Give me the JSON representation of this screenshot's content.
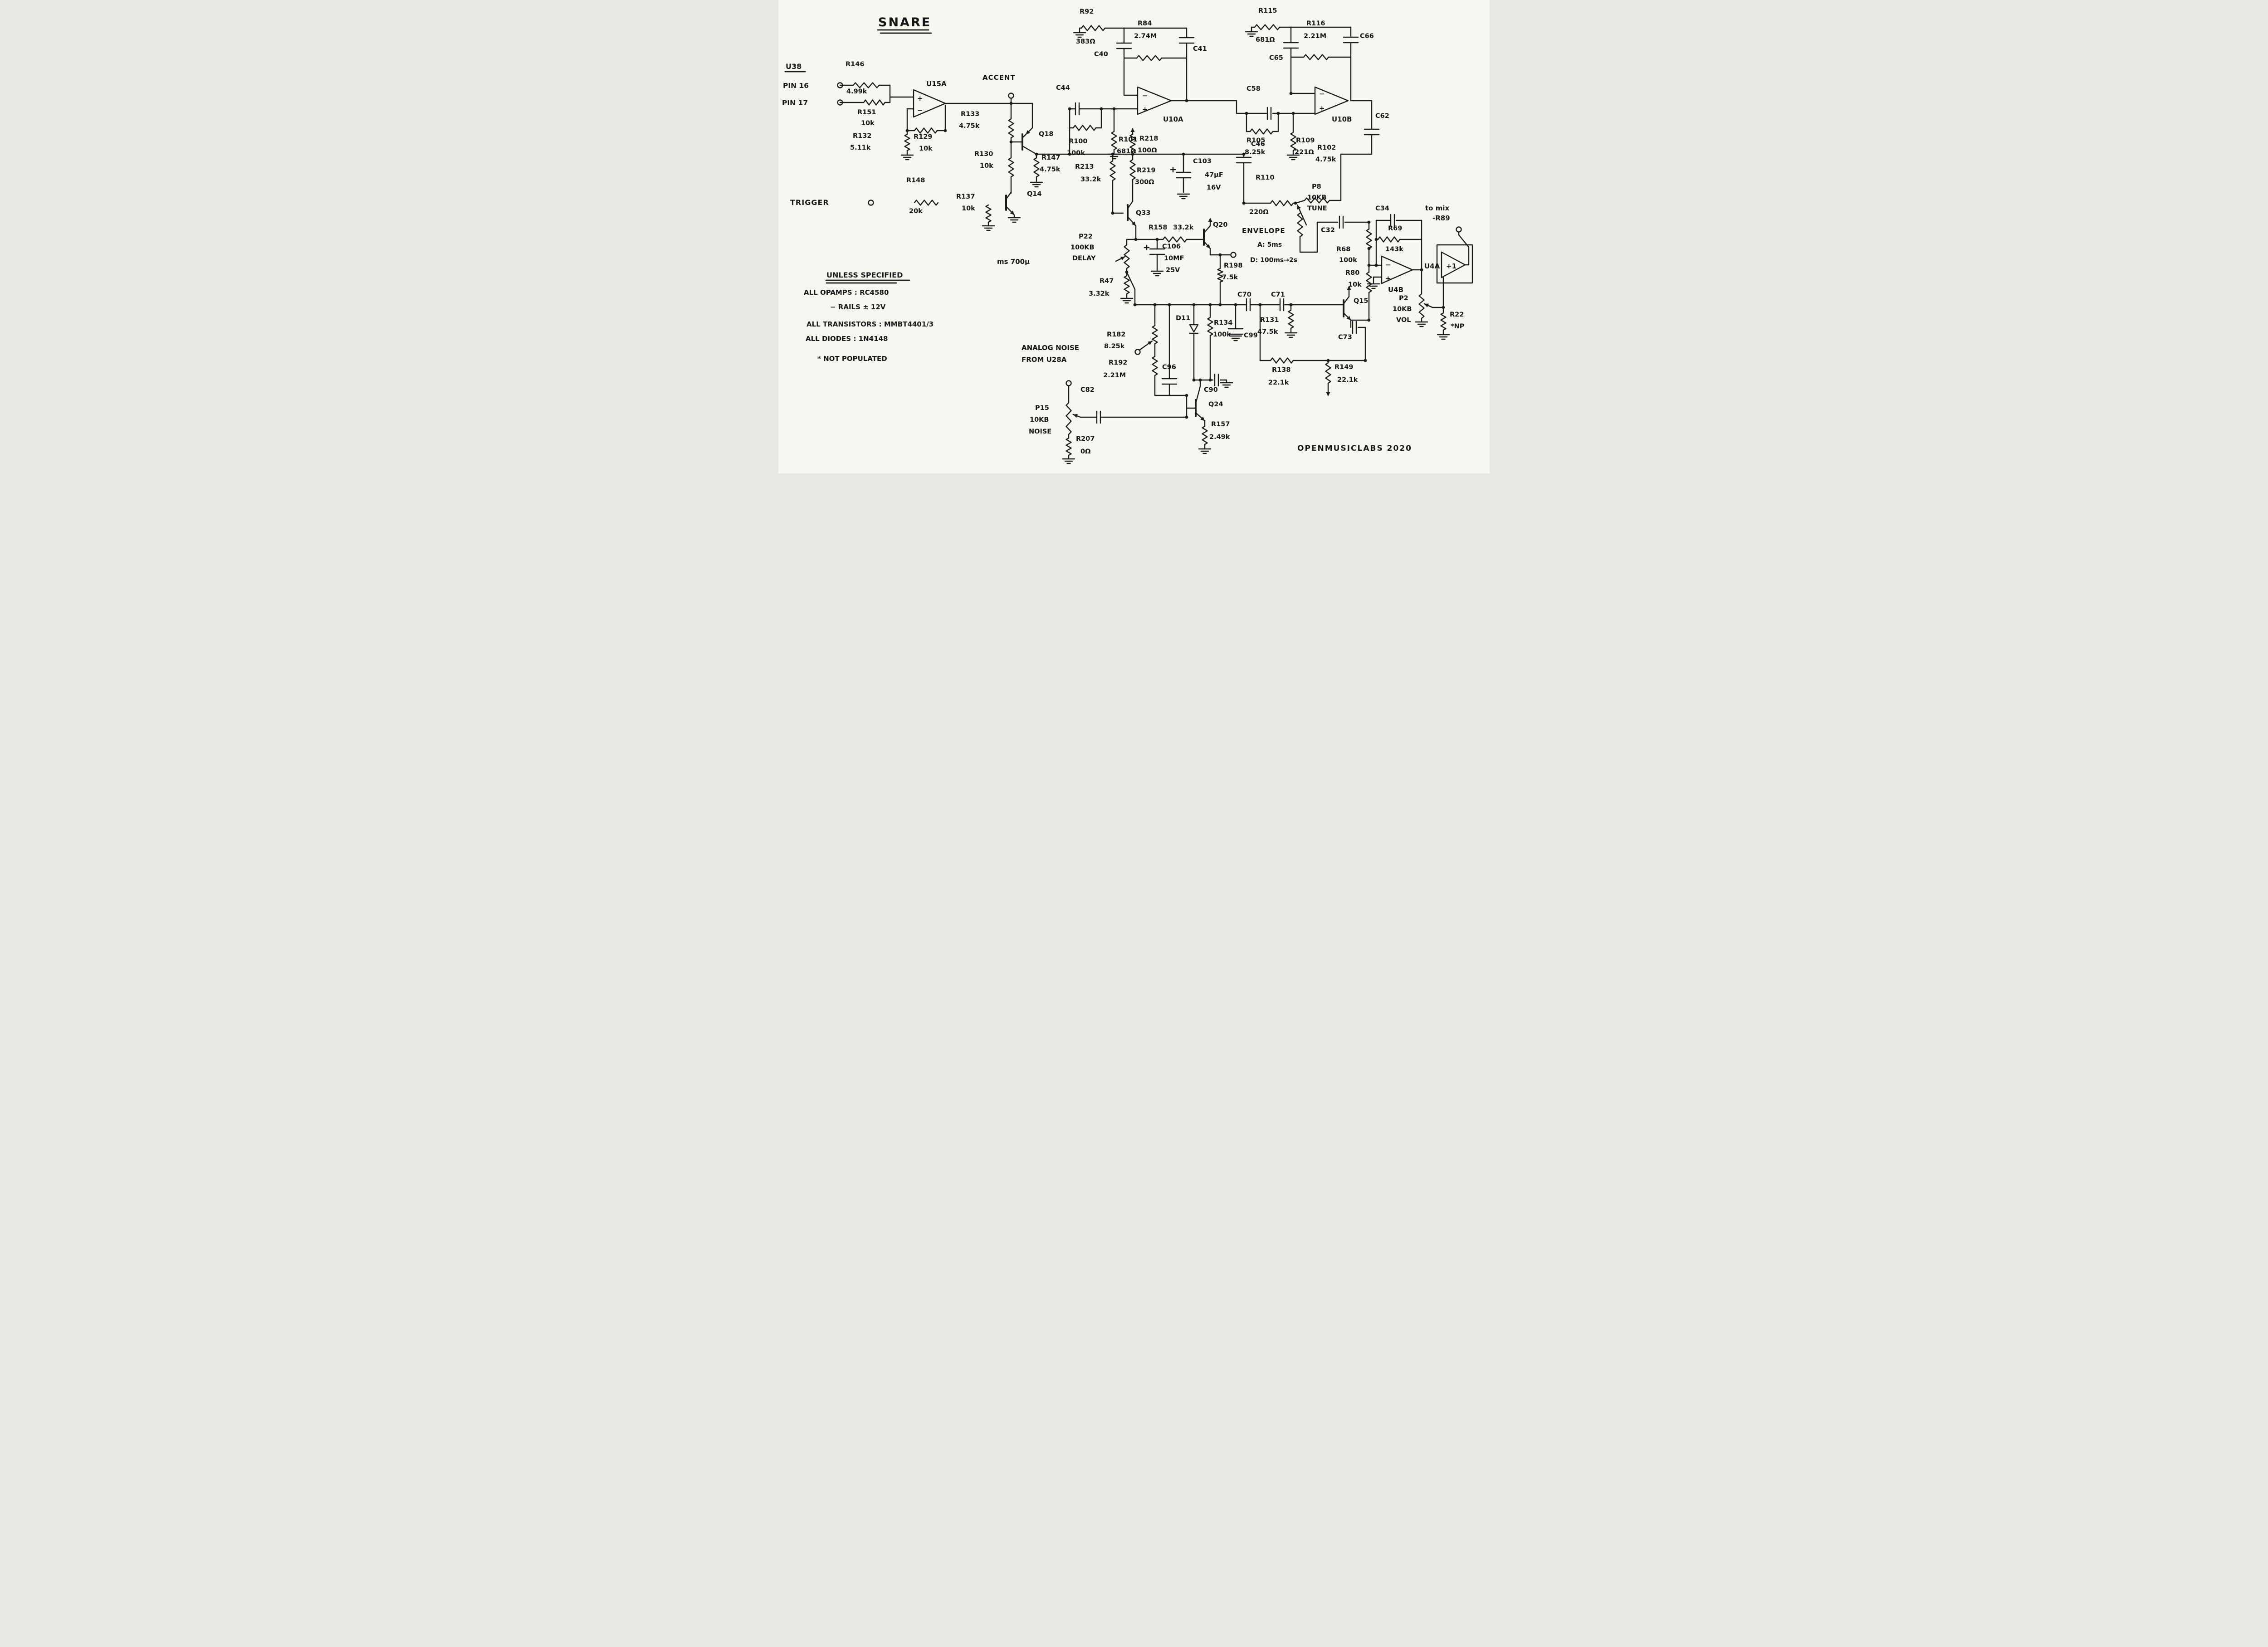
{
  "title": "SNARE",
  "footer": "OPENMUSICLABS   2020",
  "trigger_label": "TRIGGER",
  "accent_label": "ACCENT",
  "misc_label": "ms   700µ",
  "u38": {
    "label": "U38",
    "pin16": "PIN 16",
    "pin17": "PIN 17"
  },
  "noise": {
    "line1": "ANALOG NOISE",
    "line2": "FROM U28A"
  },
  "output": {
    "line1": "to mix",
    "line2": "-R89"
  },
  "buffer": {
    "gain": "+1"
  },
  "envelope": {
    "title": "ENVELOPE",
    "attack": "A: 5ms",
    "decay": "D: 100ms→2s"
  },
  "notes": {
    "heading": "UNLESS SPECIFIED",
    "l1": "ALL OPAMPS : RC4580",
    "l2": "− RAILS ± 12V",
    "l3": "ALL TRANSISTORS : MMBT4401/3",
    "l4": "ALL DIODES : 1N4148",
    "l5": "* NOT POPULATED"
  },
  "opamps": {
    "U15A": {
      "label": "U15A",
      "top": "+",
      "bottom": "−"
    },
    "U10A": {
      "label": "U10A",
      "top": "−",
      "bottom": "+"
    },
    "U10B": {
      "label": "U10B",
      "top": "−",
      "bottom": "+"
    },
    "U4B": {
      "label": "U4B",
      "top": "−",
      "bottom": "+"
    },
    "U4A": {
      "label": "U4A"
    }
  },
  "components": {
    "R146": {
      "label": "R146",
      "value": "4.99k"
    },
    "R151": {
      "label": "R151",
      "value": "10k"
    },
    "R132": {
      "label": "R132",
      "value": "5.11k"
    },
    "R129": {
      "label": "R129",
      "value": "10k"
    },
    "R133": {
      "label": "R133",
      "value": "4.75k"
    },
    "R130": {
      "label": "R130",
      "value": "10k"
    },
    "R147": {
      "label": "R147",
      "value": "4.75k"
    },
    "R148": {
      "label": "R148",
      "value": "20k"
    },
    "R137": {
      "label": "R137",
      "value": "10k"
    },
    "Q14": {
      "label": "Q14"
    },
    "Q18": {
      "label": "Q18"
    },
    "R92": {
      "label": "R92",
      "value": "383Ω"
    },
    "C40": {
      "label": "C40"
    },
    "R84": {
      "label": "R84",
      "value": "2.74M"
    },
    "C41": {
      "label": "C41"
    },
    "C44": {
      "label": "C44"
    },
    "R100": {
      "label": "R100",
      "value": "100k"
    },
    "R101": {
      "label": "R101",
      "value": "681Ω"
    },
    "R115": {
      "label": "R115",
      "value": "681Ω"
    },
    "C65": {
      "label": "C65"
    },
    "R116": {
      "label": "R116",
      "value": "2.21M"
    },
    "C66": {
      "label": "C66"
    },
    "C58": {
      "label": "C58"
    },
    "R105": {
      "label": "R105",
      "value": "8.25k"
    },
    "R109": {
      "label": "R109",
      "value": "221Ω"
    },
    "C62": {
      "label": "C62"
    },
    "C46": {
      "label": "C46"
    },
    "R110": {
      "label": "R110",
      "value": "220Ω"
    },
    "R102": {
      "label": "R102",
      "value": "4.75k"
    },
    "P8": {
      "label": "P8",
      "value": "10KB",
      "value2": "TUNE"
    },
    "R218": {
      "label": "R218",
      "value": "100Ω"
    },
    "R219": {
      "label": "R219",
      "value": "300Ω"
    },
    "C103": {
      "label": "C103",
      "value": "47µF",
      "value2": "16V"
    },
    "R213": {
      "label": "R213",
      "value": "33.2k"
    },
    "Q33": {
      "label": "Q33"
    },
    "P22": {
      "label": "P22",
      "value": "100KB",
      "value2": "DELAY"
    },
    "R47": {
      "label": "R47",
      "value": "3.32k"
    },
    "R158": {
      "label": "R158",
      "value": "33.2k"
    },
    "Q20": {
      "label": "Q20"
    },
    "C106": {
      "label": "C106",
      "value": "10MF",
      "value2": "25V"
    },
    "R198": {
      "label": "R198",
      "value": "7.5k"
    },
    "C70": {
      "label": "C70"
    },
    "C71": {
      "label": "C71"
    },
    "R131": {
      "label": "R131",
      "value": "47.5k"
    },
    "C99": {
      "label": "C99"
    },
    "Q15": {
      "label": "Q15"
    },
    "C73": {
      "label": "C73"
    },
    "R138": {
      "label": "R138",
      "value": "22.1k"
    },
    "R149": {
      "label": "R149",
      "value": "22.1k"
    },
    "R80": {
      "label": "R80",
      "value": "10k"
    },
    "C32": {
      "label": "C32"
    },
    "R68": {
      "label": "R68",
      "value": "100k"
    },
    "C34": {
      "label": "C34"
    },
    "R69": {
      "label": "R69",
      "value": "143k"
    },
    "P2": {
      "label": "P2",
      "value": "10KB",
      "value2": "VOL"
    },
    "R22": {
      "label": "R22",
      "value": "*NP"
    },
    "R182": {
      "label": "R182",
      "value": "8.25k"
    },
    "R192": {
      "label": "R192",
      "value": "2.21M"
    },
    "C96": {
      "label": "C96"
    },
    "D11": {
      "label": "D11"
    },
    "R134": {
      "label": "R134",
      "value": "100k"
    },
    "C90": {
      "label": "C90"
    },
    "Q24": {
      "label": "Q24"
    },
    "R157": {
      "label": "R157",
      "value": "2.49k"
    },
    "P15": {
      "label": "P15",
      "value": "10KB",
      "value2": "NOISE"
    },
    "C82": {
      "label": "C82"
    },
    "R207": {
      "label": "R207",
      "value": "0Ω"
    }
  }
}
